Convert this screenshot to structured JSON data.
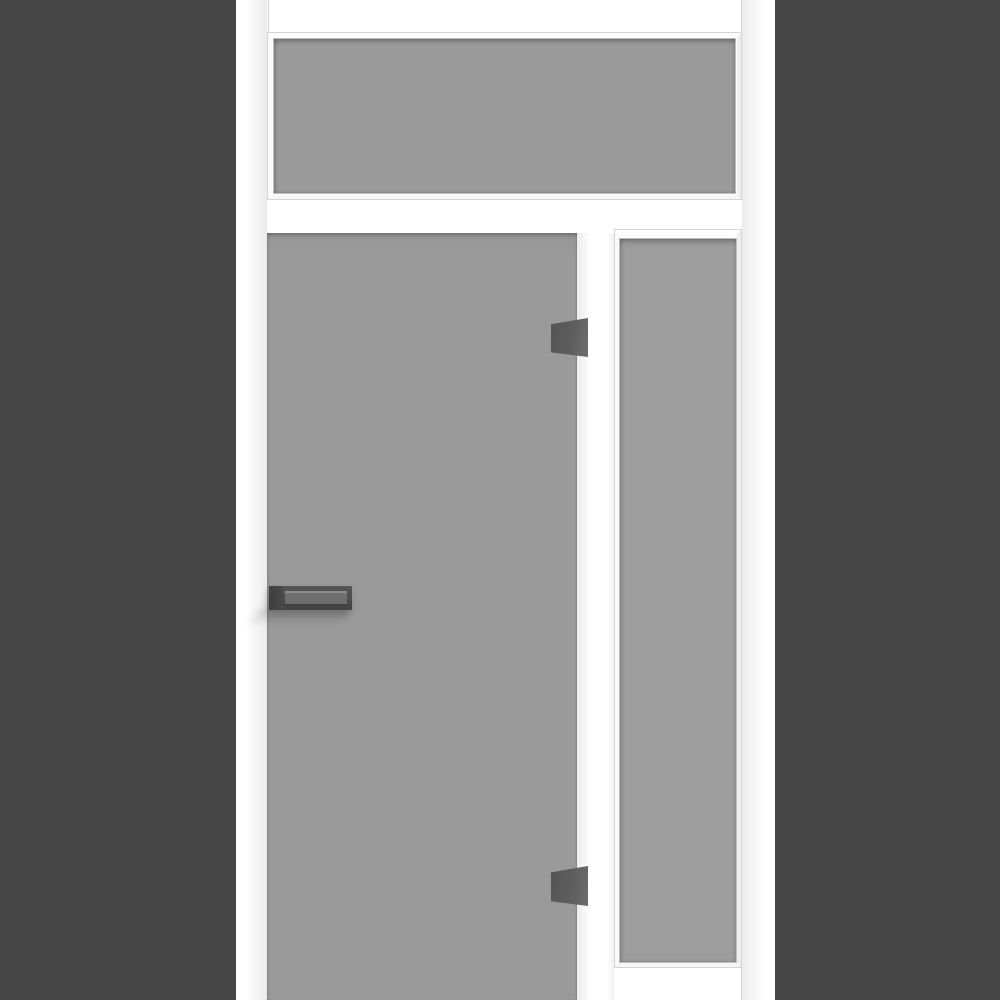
{
  "scene": {
    "title": "White interior door unit render: transom window above, frosted glass door leaf with lever handle and two glass clamps, full-height sidelight on the right, set in a dark gray wall",
    "type": "3d-product-render",
    "text_content": "none"
  },
  "colors": {
    "wall": "#474747",
    "frame": "#ffffff",
    "frame_line": "#d5d5d5",
    "glass_transom": "#9b9b9b",
    "glass_door": "#9a9a9a",
    "glass_sidelight": "#9d9d9d",
    "hinge": "#5e5e5e",
    "handle_base": "#4a4a4a",
    "handle_body": "#4d4d4d",
    "handle_face": "#6e6e6e",
    "handle_highlight": "#8d8d8d"
  },
  "elements": {
    "wall_left": "dark wall section left of frame",
    "wall_right": "dark wall section right of frame",
    "transom_window": "fixed glazed transom panel above door",
    "glass_door": "frameless frosted glass door leaf",
    "door_handle": "dark lever handle on left door edge",
    "hinge_top": "upper glass clamp hinge on right door edge",
    "hinge_bottom": "lower glass clamp hinge on right door edge",
    "sidelight_window": "fixed glazed sidelight panel on right"
  }
}
